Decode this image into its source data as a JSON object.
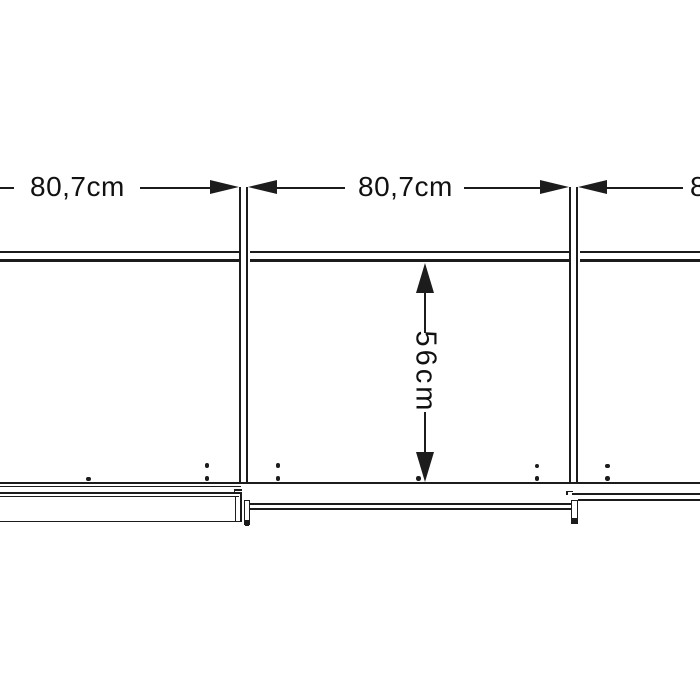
{
  "meta": {
    "description": "Technical dimension drawing: cross-section of a three-section sliding-door wardrobe, cropped at left and right edges"
  },
  "dimensions": {
    "sections": [
      {
        "label": "80,7cm"
      },
      {
        "label": "80,7cm"
      },
      {
        "label": "80,7cm"
      }
    ],
    "depth": {
      "label": "56cm"
    }
  },
  "colors": {
    "line": "#1c1c1c",
    "text": "#111111",
    "background": "#ffffff"
  }
}
